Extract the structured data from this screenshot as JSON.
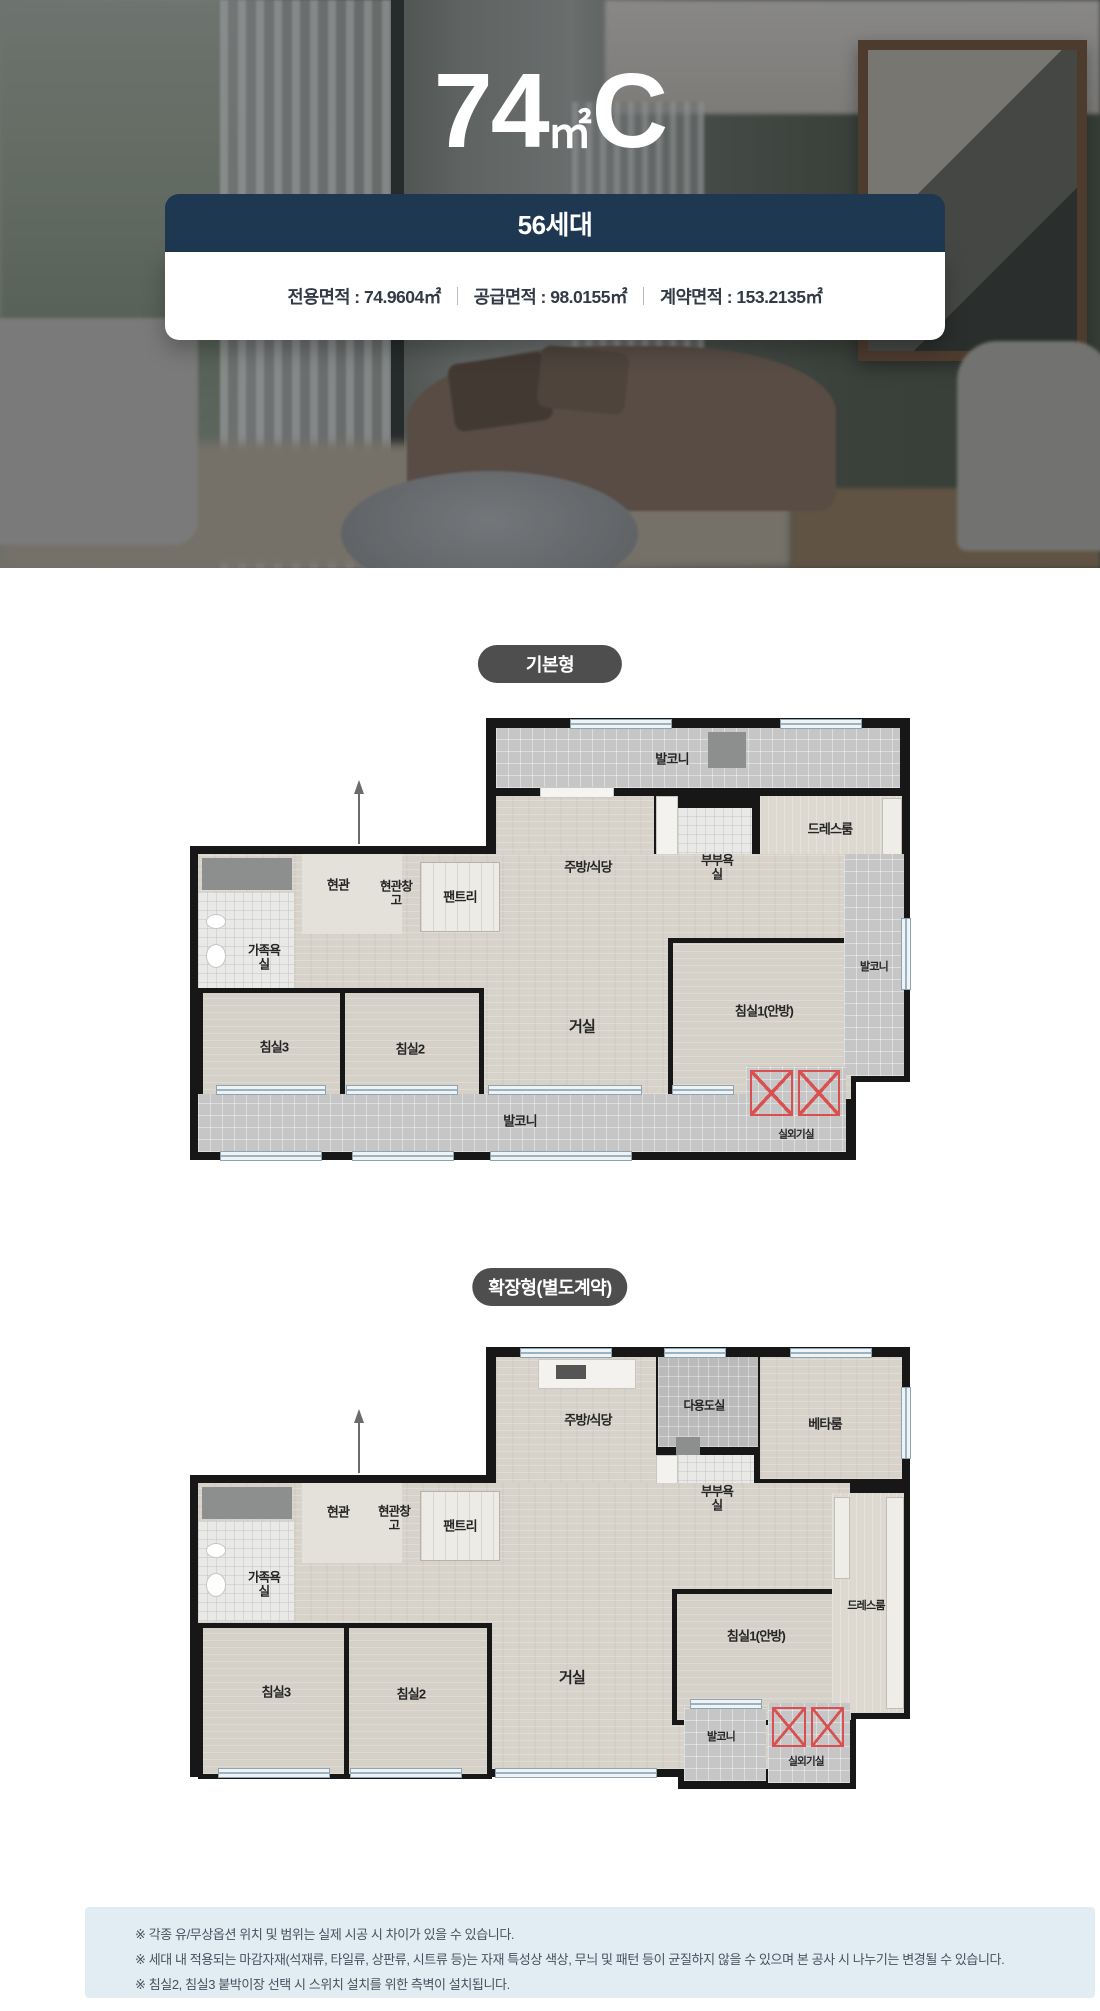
{
  "hero": {
    "title": {
      "number": "74",
      "unit": "㎡",
      "type": "C"
    },
    "units_badge": "56세대",
    "areas": [
      "전용면적 : 74.9604㎡",
      "공급면적 : 98.0155㎡",
      "계약면적 : 153.2135㎡"
    ]
  },
  "sections": {
    "basic_badge": "기본형",
    "extended_badge": "확장형(별도계약)"
  },
  "plan_basic": {
    "labels": {
      "balcony_top": "발코니",
      "dress_room": "드레스룸",
      "kitchen_dining": "주방/식당",
      "master_bath": "부부욕실",
      "entrance": "현관",
      "entrance_storage": "현관창고",
      "pantry": "팬트리",
      "family_bath": "가족욕실",
      "balcony_right": "발코니",
      "bedroom3": "침실3",
      "bedroom2": "침실2",
      "living_room": "거실",
      "bedroom1": "침실1(안방)",
      "balcony_bottom": "발코니",
      "ac_unit_room": "실외기실"
    }
  },
  "plan_extended": {
    "labels": {
      "kitchen_dining": "주방/식당",
      "utility_room": "다용도실",
      "beta_room": "베타룸",
      "master_bath": "부부욕실",
      "entrance": "현관",
      "entrance_storage": "현관창고",
      "pantry": "팬트리",
      "family_bath": "가족욕실",
      "bedroom3": "침실3",
      "bedroom2": "침실2",
      "living_room": "거실",
      "bedroom1": "침실1(안방)",
      "dress_room": "드레스룸",
      "balcony": "발코니",
      "ac_unit_room": "실외기실"
    }
  },
  "footer": {
    "notes": [
      "※ 각종 유/무상옵션 위치 및 범위는 실제 시공 시 차이가 있을 수 있습니다.",
      "※ 세대 내 적용되는 마감자재(석재류, 타일류, 상판류, 시트류 등)는 자재 특성상 색상, 무늬 및 패턴 등이 균질하지 않을 수 있으며 본 공사 시 나누기는 변경될 수 있습니다.",
      "※ 침실2, 침실3 붙박이장 선택 시 스위치 설치를 위한 측벽이 설치됩니다."
    ]
  }
}
